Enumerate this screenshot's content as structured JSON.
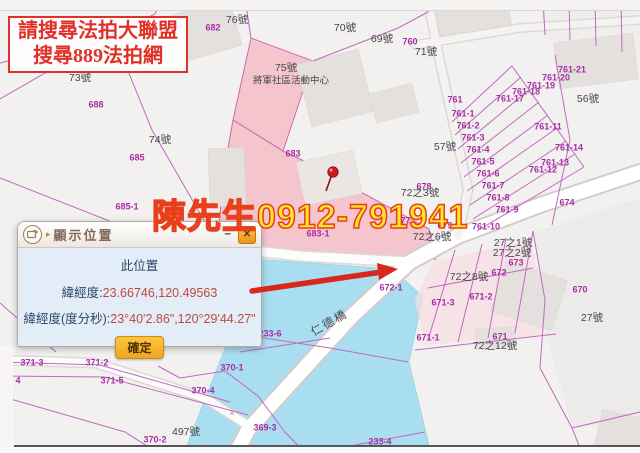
{
  "notice": {
    "line1": "請搜尋法拍大聯盟",
    "line2": "搜尋889法拍網"
  },
  "watermark": {
    "text": "陳先生0912-791941",
    "fill": "#fbe62b",
    "outline": "#e8401c"
  },
  "dialog": {
    "title": "顯示位置",
    "minimize_label": "–",
    "close_label": "✕",
    "heading": "此位置",
    "latlon_label": "緯經度:",
    "latlon_value": "23.66746,120.49563",
    "dms_label": "緯經度(度分秒):",
    "dms_value": "23°40'2.86\",120°29'44.27\"",
    "confirm_label": "確定"
  },
  "colors": {
    "water": "#a8def0",
    "highlight_parcel": "#f4c5cd",
    "parcel_line": "#c168c1",
    "parcel_label": "#a52fa5",
    "address_label": "#45454e",
    "arrow": "#d8281c",
    "notice_red": "#e13028"
  },
  "map": {
    "labels": [
      {
        "t": "682",
        "x": 213,
        "y": 28,
        "k": "p"
      },
      {
        "t": "760",
        "x": 410,
        "y": 42,
        "k": "p"
      },
      {
        "t": "688",
        "x": 96,
        "y": 105,
        "k": "p"
      },
      {
        "t": "683",
        "x": 293,
        "y": 154,
        "k": "p"
      },
      {
        "t": "685",
        "x": 137,
        "y": 158,
        "k": "p"
      },
      {
        "t": "685-1",
        "x": 127,
        "y": 207,
        "k": "p"
      },
      {
        "t": "683-1",
        "x": 318,
        "y": 234,
        "k": "p"
      },
      {
        "t": "672-1",
        "x": 391,
        "y": 288,
        "k": "p"
      },
      {
        "t": "761",
        "x": 455,
        "y": 100,
        "k": "p"
      },
      {
        "t": "761-1",
        "x": 463,
        "y": 114,
        "k": "p"
      },
      {
        "t": "761-2",
        "x": 468,
        "y": 126,
        "k": "p"
      },
      {
        "t": "761-3",
        "x": 473,
        "y": 138,
        "k": "p"
      },
      {
        "t": "761-4",
        "x": 478,
        "y": 150,
        "k": "p"
      },
      {
        "t": "761-5",
        "x": 483,
        "y": 162,
        "k": "p"
      },
      {
        "t": "761-6",
        "x": 488,
        "y": 174,
        "k": "p"
      },
      {
        "t": "761-7",
        "x": 493,
        "y": 186,
        "k": "p"
      },
      {
        "t": "761-8",
        "x": 498,
        "y": 198,
        "k": "p"
      },
      {
        "t": "761-9",
        "x": 507,
        "y": 210,
        "k": "p"
      },
      {
        "t": "761-10",
        "x": 486,
        "y": 227,
        "k": "p"
      },
      {
        "t": "761-11",
        "x": 548,
        "y": 127,
        "k": "p"
      },
      {
        "t": "761-12",
        "x": 543,
        "y": 170,
        "k": "p"
      },
      {
        "t": "761-13",
        "x": 555,
        "y": 163,
        "k": "p"
      },
      {
        "t": "761-14",
        "x": 569,
        "y": 148,
        "k": "p"
      },
      {
        "t": "761-17",
        "x": 510,
        "y": 99,
        "k": "p"
      },
      {
        "t": "761-18",
        "x": 526,
        "y": 92,
        "k": "p"
      },
      {
        "t": "761-19",
        "x": 541,
        "y": 86,
        "k": "p"
      },
      {
        "t": "761-20",
        "x": 556,
        "y": 78,
        "k": "p"
      },
      {
        "t": "761-21",
        "x": 572,
        "y": 70,
        "k": "p"
      },
      {
        "t": "674",
        "x": 567,
        "y": 203,
        "k": "p"
      },
      {
        "t": "677",
        "x": 403,
        "y": 221,
        "k": "p"
      },
      {
        "t": "678",
        "x": 424,
        "y": 187,
        "k": "p"
      },
      {
        "t": "679",
        "x": 445,
        "y": 226,
        "k": "p"
      },
      {
        "t": "670",
        "x": 580,
        "y": 290,
        "k": "p"
      },
      {
        "t": "671",
        "x": 500,
        "y": 337,
        "k": "p"
      },
      {
        "t": "671-1",
        "x": 428,
        "y": 338,
        "k": "p"
      },
      {
        "t": "671-2",
        "x": 481,
        "y": 297,
        "k": "p"
      },
      {
        "t": "671-3",
        "x": 443,
        "y": 303,
        "k": "p"
      },
      {
        "t": "672",
        "x": 499,
        "y": 273,
        "k": "p"
      },
      {
        "t": "673",
        "x": 516,
        "y": 263,
        "k": "p"
      },
      {
        "t": "233-6",
        "x": 270,
        "y": 334,
        "k": "p"
      },
      {
        "t": "233-4",
        "x": 380,
        "y": 442,
        "k": "p"
      },
      {
        "t": "370-1",
        "x": 232,
        "y": 368,
        "k": "p"
      },
      {
        "t": "370-4",
        "x": 203,
        "y": 391,
        "k": "p"
      },
      {
        "t": "370-2",
        "x": 155,
        "y": 440,
        "k": "p"
      },
      {
        "t": "369-3",
        "x": 265,
        "y": 428,
        "k": "p"
      },
      {
        "t": "371-3",
        "x": 32,
        "y": 363,
        "k": "p"
      },
      {
        "t": "371-2",
        "x": 97,
        "y": 363,
        "k": "p"
      },
      {
        "t": "371-5",
        "x": 112,
        "y": 381,
        "k": "p"
      },
      {
        "t": "4",
        "x": 18,
        "y": 381,
        "k": "p"
      },
      {
        "t": "73號",
        "x": 80,
        "y": 78,
        "k": "a"
      },
      {
        "t": "76號",
        "x": 237,
        "y": 20,
        "k": "a"
      },
      {
        "t": "70號",
        "x": 345,
        "y": 28,
        "k": "a"
      },
      {
        "t": "69號",
        "x": 382,
        "y": 39,
        "k": "a"
      },
      {
        "t": "71號",
        "x": 426,
        "y": 52,
        "k": "a"
      },
      {
        "t": "74號",
        "x": 160,
        "y": 140,
        "k": "a"
      },
      {
        "t": "75號",
        "x": 286,
        "y": 68,
        "k": "a"
      },
      {
        "t": "將軍社區活動中心",
        "x": 291,
        "y": 81,
        "k": "s"
      },
      {
        "t": "56號",
        "x": 588,
        "y": 99,
        "k": "a"
      },
      {
        "t": "57號",
        "x": 445,
        "y": 147,
        "k": "a"
      },
      {
        "t": "72之3號",
        "x": 420,
        "y": 193,
        "k": "a"
      },
      {
        "t": "72之6號",
        "x": 432,
        "y": 237,
        "k": "a"
      },
      {
        "t": "27之1號",
        "x": 513,
        "y": 243,
        "k": "a"
      },
      {
        "t": "27之2號",
        "x": 512,
        "y": 253,
        "k": "a"
      },
      {
        "t": "72之8號",
        "x": 469,
        "y": 277,
        "k": "a"
      },
      {
        "t": "27號",
        "x": 592,
        "y": 318,
        "k": "a"
      },
      {
        "t": "497號",
        "x": 186,
        "y": 432,
        "k": "a"
      },
      {
        "t": "72之12號",
        "x": 495,
        "y": 346,
        "k": "a"
      },
      {
        "t": "仁德橋",
        "x": 330,
        "y": 324,
        "k": "b"
      },
      {
        "t": "×",
        "x": 438,
        "y": 241,
        "k": "m"
      },
      {
        "t": "×",
        "x": 232,
        "y": 414,
        "k": "m"
      }
    ]
  }
}
